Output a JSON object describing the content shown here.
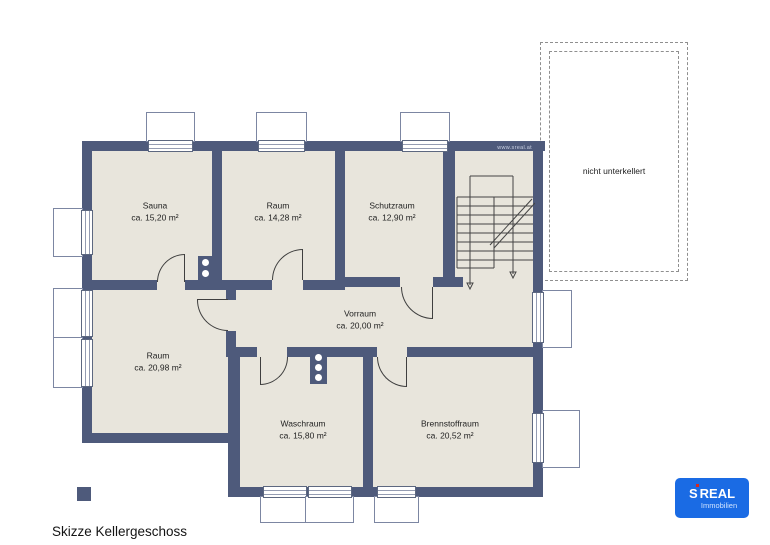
{
  "title": "Skizze Kellergeschoss",
  "watermark": "www.sreal.at",
  "rooms": [
    {
      "name": "Sauna",
      "area": "ca. 15,20 m²"
    },
    {
      "name": "Raum",
      "area": "ca. 14,28 m²"
    },
    {
      "name": "Schutzraum",
      "area": "ca. 12,90 m²"
    },
    {
      "name": "Vorraum",
      "area": "ca. 20,00 m²"
    },
    {
      "name": "Raum",
      "area": "ca. 20,98 m²"
    },
    {
      "name": "Waschraum",
      "area": "ca. 15,80 m²"
    },
    {
      "name": "Brennstoffraum",
      "area": "ca. 20,52 m²"
    }
  ],
  "annotations": {
    "not_basemented": "nicht unterkellert"
  },
  "logo": {
    "brand_s": "S",
    "brand_name": "REAL",
    "brand_sub": "Immobilien"
  },
  "colors": {
    "wall": "#4e5a7b",
    "room_fill": "#e8e5dc",
    "logo_blue": "#1a6be4",
    "logo_dot_red": "#d8281e",
    "lightwell_outline": "#7c86a2"
  }
}
